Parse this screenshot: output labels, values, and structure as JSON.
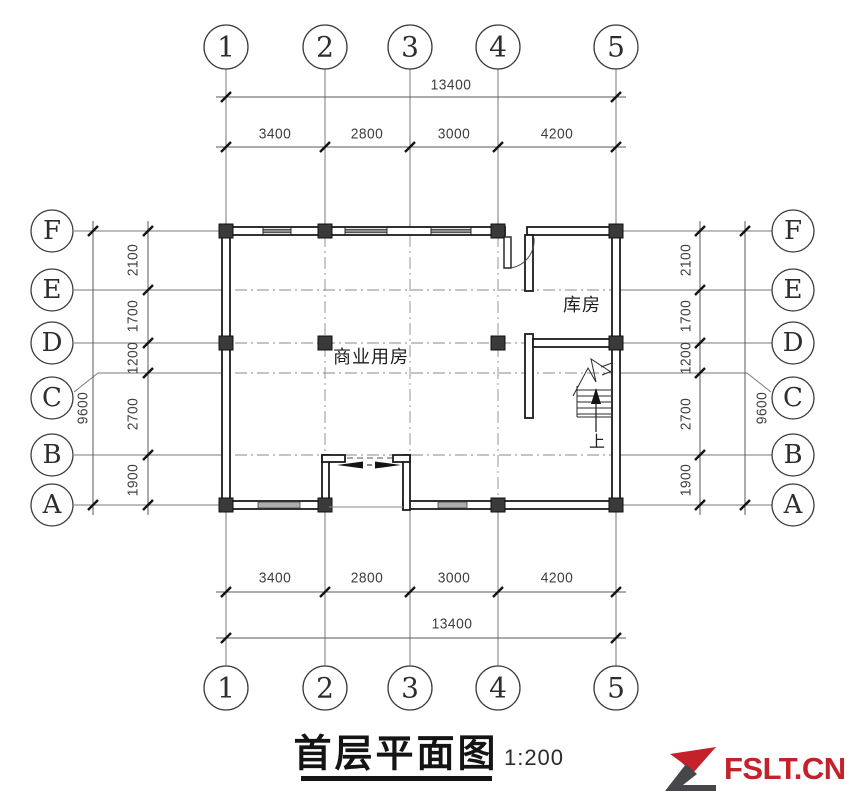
{
  "drawing": {
    "title": "首层平面图",
    "scale": "1:200",
    "axes": {
      "cols": [
        "1",
        "2",
        "3",
        "4",
        "5"
      ],
      "rows": [
        "F",
        "E",
        "D",
        "C",
        "B",
        "A"
      ]
    },
    "dims": {
      "h_total": "13400",
      "h_segments": [
        "3400",
        "2800",
        "3000",
        "4200"
      ],
      "v_total": "9600",
      "v_segments": [
        "2100",
        "1700",
        "1200",
        "2700",
        "1900"
      ]
    },
    "rooms": {
      "commercial": "商业用房",
      "storage": "库房"
    },
    "stair": {
      "direction_label": "上"
    }
  },
  "watermark": {
    "brand": "FSLT.CN"
  },
  "colors": {
    "wall": "#1b1b1b",
    "grid_line": "#7a7a7a",
    "dim_text": "#3f3f3f",
    "column_fill": "#3a3a3a",
    "window_fill": "#adadad",
    "logo_red": "#c4212a",
    "logo_gray": "#47474b"
  }
}
